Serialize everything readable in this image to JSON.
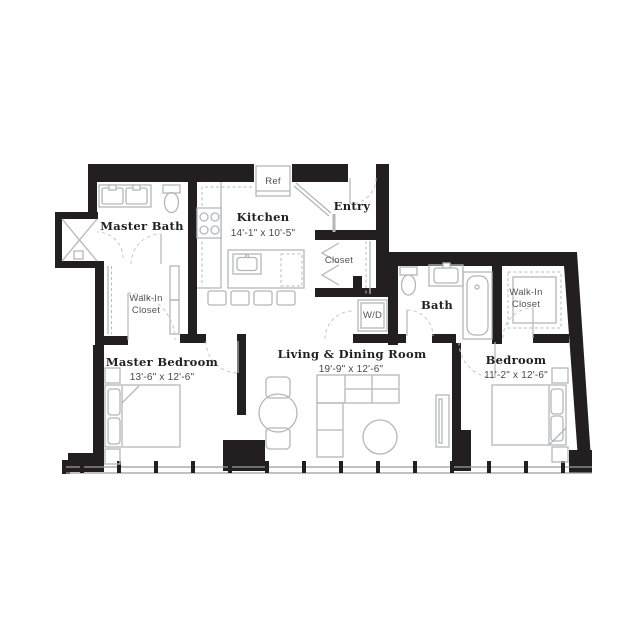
{
  "floor_plan": {
    "rooms": {
      "master_bath": {
        "label": "Master Bath"
      },
      "kitchen": {
        "label": "Kitchen",
        "dims": "14'-1\" x 10'-5\""
      },
      "entry": {
        "label": "Entry"
      },
      "hall_closet": {
        "label": "Closet"
      },
      "bath": {
        "label": "Bath"
      },
      "master_walk_in_closet": {
        "line1": "Walk-In",
        "line2": "Closet"
      },
      "bedroom_walk_in_closet": {
        "line1": "Walk-In",
        "line2": "Closet"
      },
      "master_bedroom": {
        "label": "Master Bedroom",
        "dims": "13'-6\" x 12'-6\""
      },
      "living_dining": {
        "label": "Living & Dining Room",
        "dims": "19'-9\" x 12'-6\""
      },
      "bedroom": {
        "label": "Bedroom",
        "dims": "11'-2\" x 12'-6\""
      }
    },
    "appliances": {
      "refrigerator": {
        "label": "Ref"
      },
      "washer_dryer": {
        "label": "W/D"
      }
    },
    "colors": {
      "wall": "#231f20",
      "fixture_line": "#b4b6b8",
      "door_arc": "#c6c7c9",
      "window_line": "#9a9c9e",
      "label_serif": "#231f20",
      "label_sans": "#515356",
      "background": "#ffffff"
    }
  }
}
